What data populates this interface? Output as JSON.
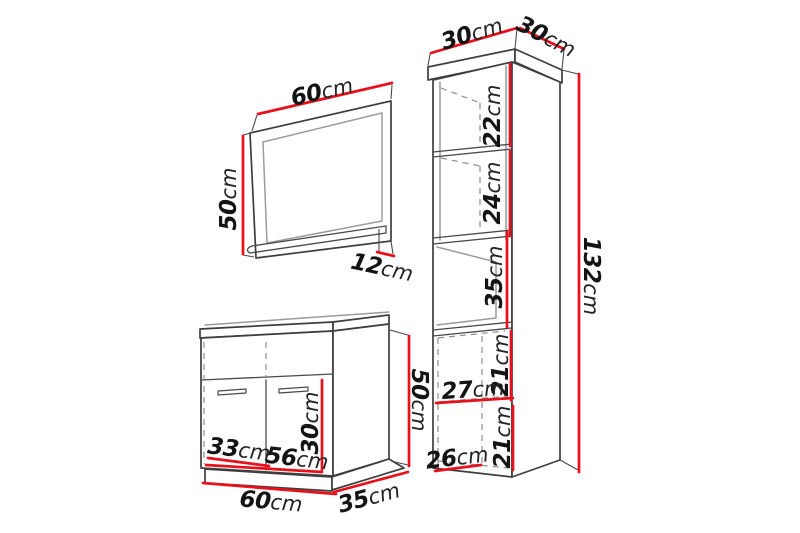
{
  "colors": {
    "dimension_line": "#e8101a",
    "outline": "#3e3e3e",
    "inner_line": "#9b9b9b",
    "dashed_line": "#8d8d8d",
    "text": "#141414",
    "background": "#ffffff"
  },
  "mirror": {
    "width": {
      "value": "60",
      "unit": "cm"
    },
    "height": {
      "value": "50",
      "unit": "cm"
    },
    "shelf_depth": {
      "value": "12",
      "unit": "cm"
    }
  },
  "washbasin_cabinet": {
    "left_door_width": {
      "value": "33",
      "unit": "cm"
    },
    "inner_width": {
      "value": "56",
      "unit": "cm"
    },
    "door_height": {
      "value": "30",
      "unit": "cm"
    },
    "height": {
      "value": "50",
      "unit": "cm"
    },
    "width": {
      "value": "60",
      "unit": "cm"
    },
    "depth": {
      "value": "35",
      "unit": "cm"
    }
  },
  "tall_cabinet": {
    "width": {
      "value": "30",
      "unit": "cm"
    },
    "depth": {
      "value": "30",
      "unit": "cm"
    },
    "upper_shelf_height": {
      "value": "22",
      "unit": "cm"
    },
    "lower_shelf_height": {
      "value": "24",
      "unit": "cm"
    },
    "open_niche_height": {
      "value": "35",
      "unit": "cm"
    },
    "upper_door_height": {
      "value": "21",
      "unit": "cm"
    },
    "door_width": {
      "value": "27",
      "unit": "cm"
    },
    "lower_door_height": {
      "value": "21",
      "unit": "cm"
    },
    "bottom_width": {
      "value": "26",
      "unit": "cm"
    },
    "total_height": {
      "value": "132",
      "unit": "cm"
    }
  }
}
